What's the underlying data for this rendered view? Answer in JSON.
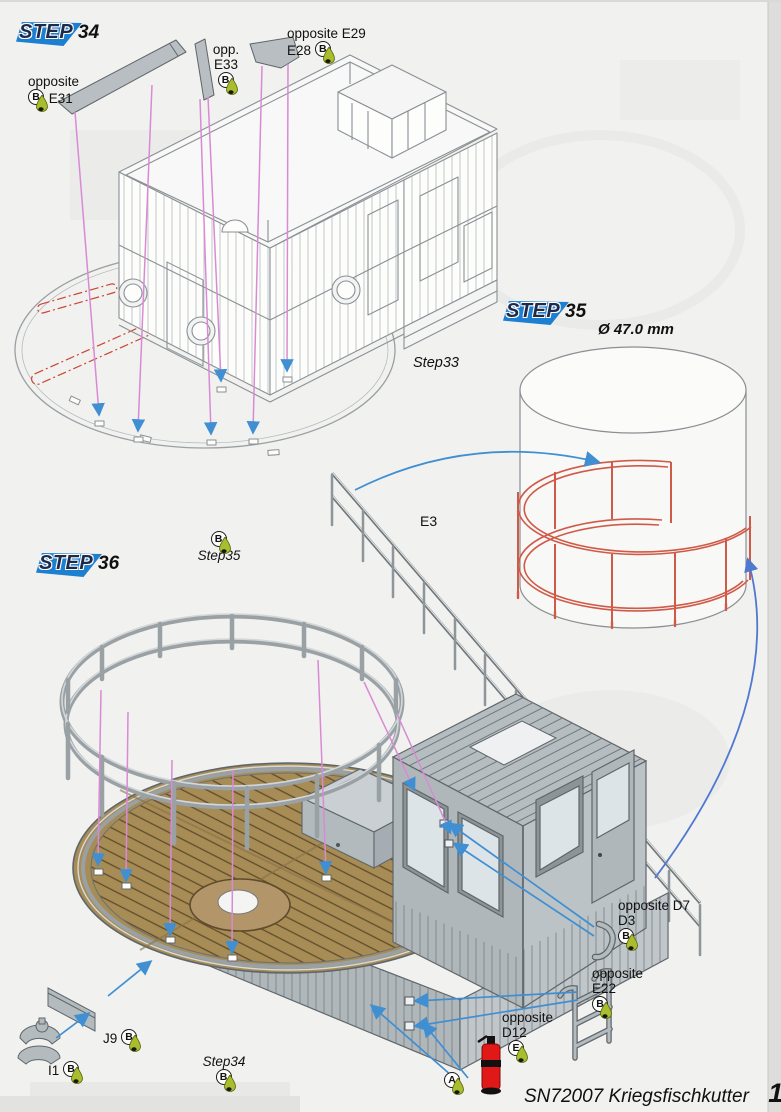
{
  "page": {
    "footer": {
      "title": "SN72007 Kriegsfischkutter",
      "page_number": "11"
    }
  },
  "steps": {
    "s34": {
      "word": "STEP",
      "number": "34"
    },
    "s35": {
      "word": "STEP",
      "number": "35"
    },
    "s36": {
      "word": "STEP",
      "number": "36"
    }
  },
  "labels": {
    "e31": {
      "line1": "opposite",
      "part": "E31",
      "glue": "B"
    },
    "e33": {
      "line1": "opp.",
      "part": "E33",
      "glue": "B"
    },
    "e28": {
      "line1": "opposite E29",
      "part": "E28",
      "glue": "B"
    },
    "step33": {
      "text": "Step33"
    },
    "diameter": {
      "text": "Ø 47.0 mm"
    },
    "e3": {
      "text": "E3"
    },
    "step35": {
      "text": "Step35",
      "glue": "B"
    },
    "d7": {
      "line1": "opposite D7",
      "part": "D3",
      "glue": "B"
    },
    "e22": {
      "line1": "opposite",
      "part": "E22",
      "glue": "B"
    },
    "d12": {
      "line1": "opposite",
      "part": "D12",
      "glue": "E"
    },
    "j9": {
      "part": "J9",
      "glue": "B"
    },
    "i1": {
      "part": "I1",
      "glue": "B"
    },
    "step34": {
      "text": "Step34",
      "glue": "B"
    },
    "a": {
      "glue": "A"
    }
  },
  "colors": {
    "banner_blue": "#1c7fd0",
    "railing_red": "#d05a48",
    "arrow_blue": "#3f8fd2",
    "leader_pink": "#d98ad4",
    "deck_brown": "#a78c56",
    "glue_green": "#a9bd2d",
    "extinguisher_red": "#e01818"
  }
}
